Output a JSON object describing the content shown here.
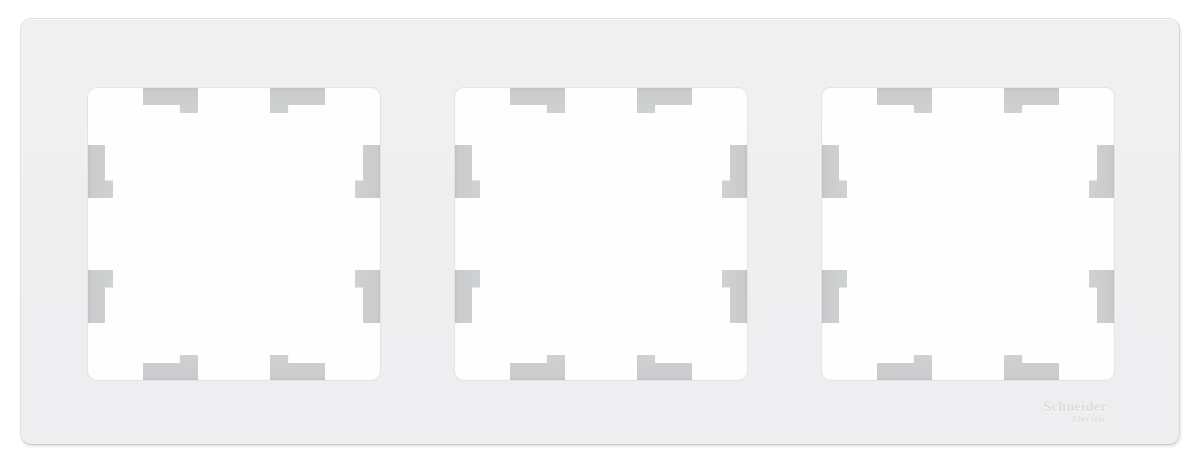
{
  "product": {
    "type": "3-gang wall switch/socket frame",
    "gang_count": 3,
    "logo": {
      "line1": "Schneider",
      "line2": "Electric"
    }
  },
  "colors": {
    "page_bg": "#ffffff",
    "frame_fill": "#f0f0f1",
    "frame_edge": "#e2e3e4",
    "frame_edge_dark": "#c9cacb",
    "opening_fill": "#fefefe",
    "opening_ring": "#e3e4e5",
    "tab_light": "#cfd1d2",
    "tab_dark": "#c4c6c7",
    "logo_text": "#dbdcde"
  }
}
